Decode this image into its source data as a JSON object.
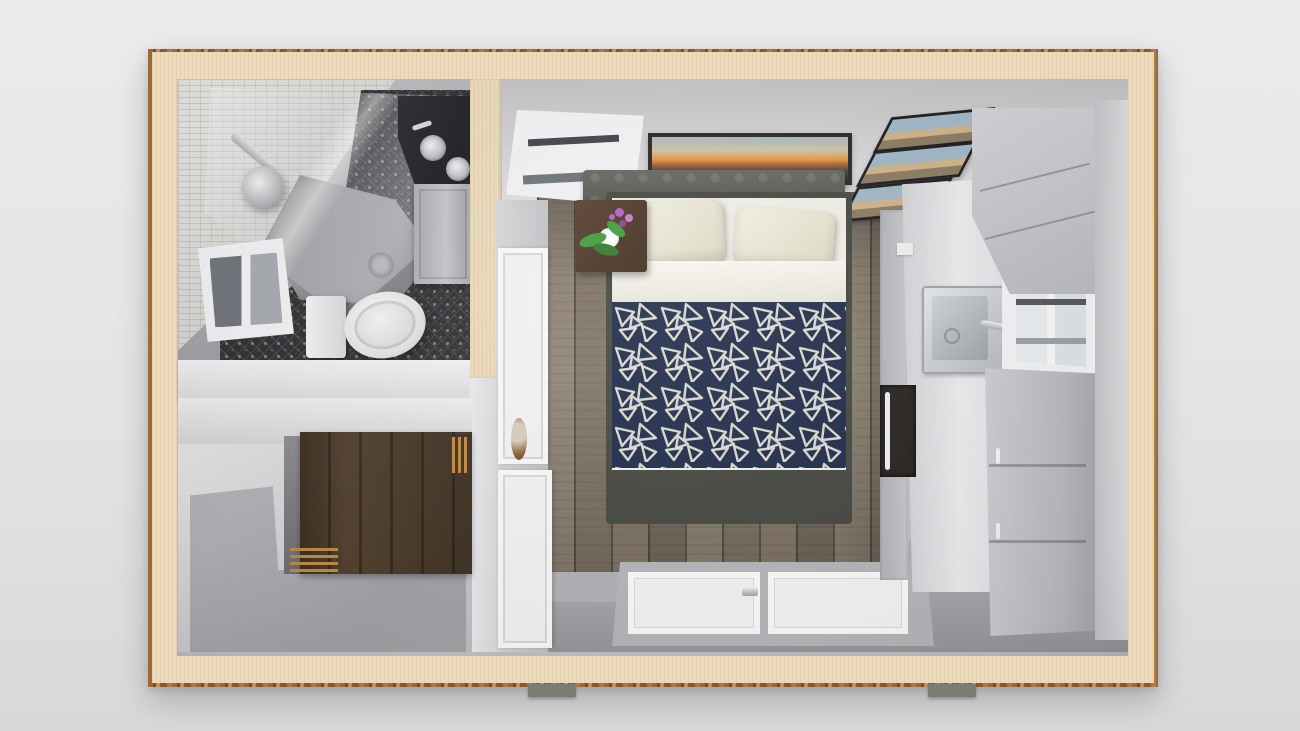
{
  "scene": {
    "kind": "3D floor plan, top-down render of a studio tiny home",
    "rooms": [
      {
        "id": "bathroom",
        "label": "Bathroom with corner shower, vanity and toilet"
      },
      {
        "id": "bonus_room",
        "label": "Bonus room with barn-wood accent wall"
      },
      {
        "id": "main_room",
        "label": "Bedroom and living area"
      },
      {
        "id": "kitchen",
        "label": "Kitchenette along right wall"
      }
    ]
  },
  "labels": {
    "building": "Tiny home floor plan, top-down 3D render",
    "bathroom": "Bathroom",
    "bonus_room": "Bonus room",
    "main_room": "Bedroom / living area",
    "kitchen": "Kitchenette",
    "mosaic_wall": "Mosaic tile wall",
    "tile_floor": "Patterned dark tile floor",
    "shower": "Neo-angle glass shower",
    "shower_head": "Shower head",
    "vanity": "Vanity with vessel sinks",
    "toilet": "Toilet",
    "bath_window": "Bathroom window",
    "barn_wall": "Barn-wood accent wall",
    "gold_slats": "Wood slat detail",
    "wood_floor": "Plank wood floor",
    "gray_floor": "Concrete-gray floor",
    "bed": "Bed with navy geometric duvet",
    "headboard": "Upholstered headboard",
    "pillow": "Pillow",
    "duvet": "Navy duvet with white triangle pattern",
    "nightstand": "Nightstand with orchid",
    "orchid": "Orchid plant",
    "artwork": "Panoramic sunset artwork",
    "photos": "Framed photo set",
    "window": "Window",
    "door": "Interior door",
    "door_knob": "Round door detail",
    "patio_door": "Glass patio door",
    "counter": "Kitchen countertop",
    "kitchen_sink": "Kitchen sink",
    "microwave": "Microwave",
    "upper_cabinet": "Upper cabinet",
    "tall_cabinet": "Tall cabinet / refrigerator unit",
    "pier": "Foundation pier"
  },
  "colors": {
    "bg_top": "#ebebed",
    "bg_bottom": "#d8d8da",
    "wall_cream": "#ecdcbd",
    "mosaic": "#d4d4d0",
    "tile_dark": "#303033",
    "tile_dot": "#7c7c82",
    "shower_pan": "#8f8f93",
    "black_counter": "#1c1c22",
    "floor_gray": "#a3a3a7",
    "wood_a": "#8b7f70",
    "wood_b": "#7c7061",
    "wood_c": "#71665a",
    "duvet_navy": "#1f2b49",
    "duvet_fill": "#2c3a60",
    "duvet_line": "#d9d9d0",
    "pillow": "#ddd9c4",
    "sheet": "#f0eee5",
    "headboard": "#4e504b",
    "bedframe": "#44463f",
    "nightstand": "#3e2b1d",
    "leaf": "#3e9b3b",
    "orchid": "#b75fc8",
    "art_frame": "#26262a",
    "art_sky": "#a8b6c0",
    "art_gold": "#e6953f",
    "art_dark": "#232b36",
    "photo_frame": "#1b1b1d",
    "photo_sky": "#9fb7c6",
    "photo_sand": "#cdb288",
    "trim_white": "#f3f3f5",
    "counter": "#ececef",
    "cabinet": "#c6c6cb",
    "cabinet_dark": "#b9b9be",
    "appliance_dark": "#26221f",
    "steel": "#b4b8bb",
    "barnwood_a": "#53412e",
    "barnwood_b": "#3a2d20",
    "gold": "#c08c42",
    "door_knob": "#8a5a2e",
    "pier": "#7c7c74"
  }
}
